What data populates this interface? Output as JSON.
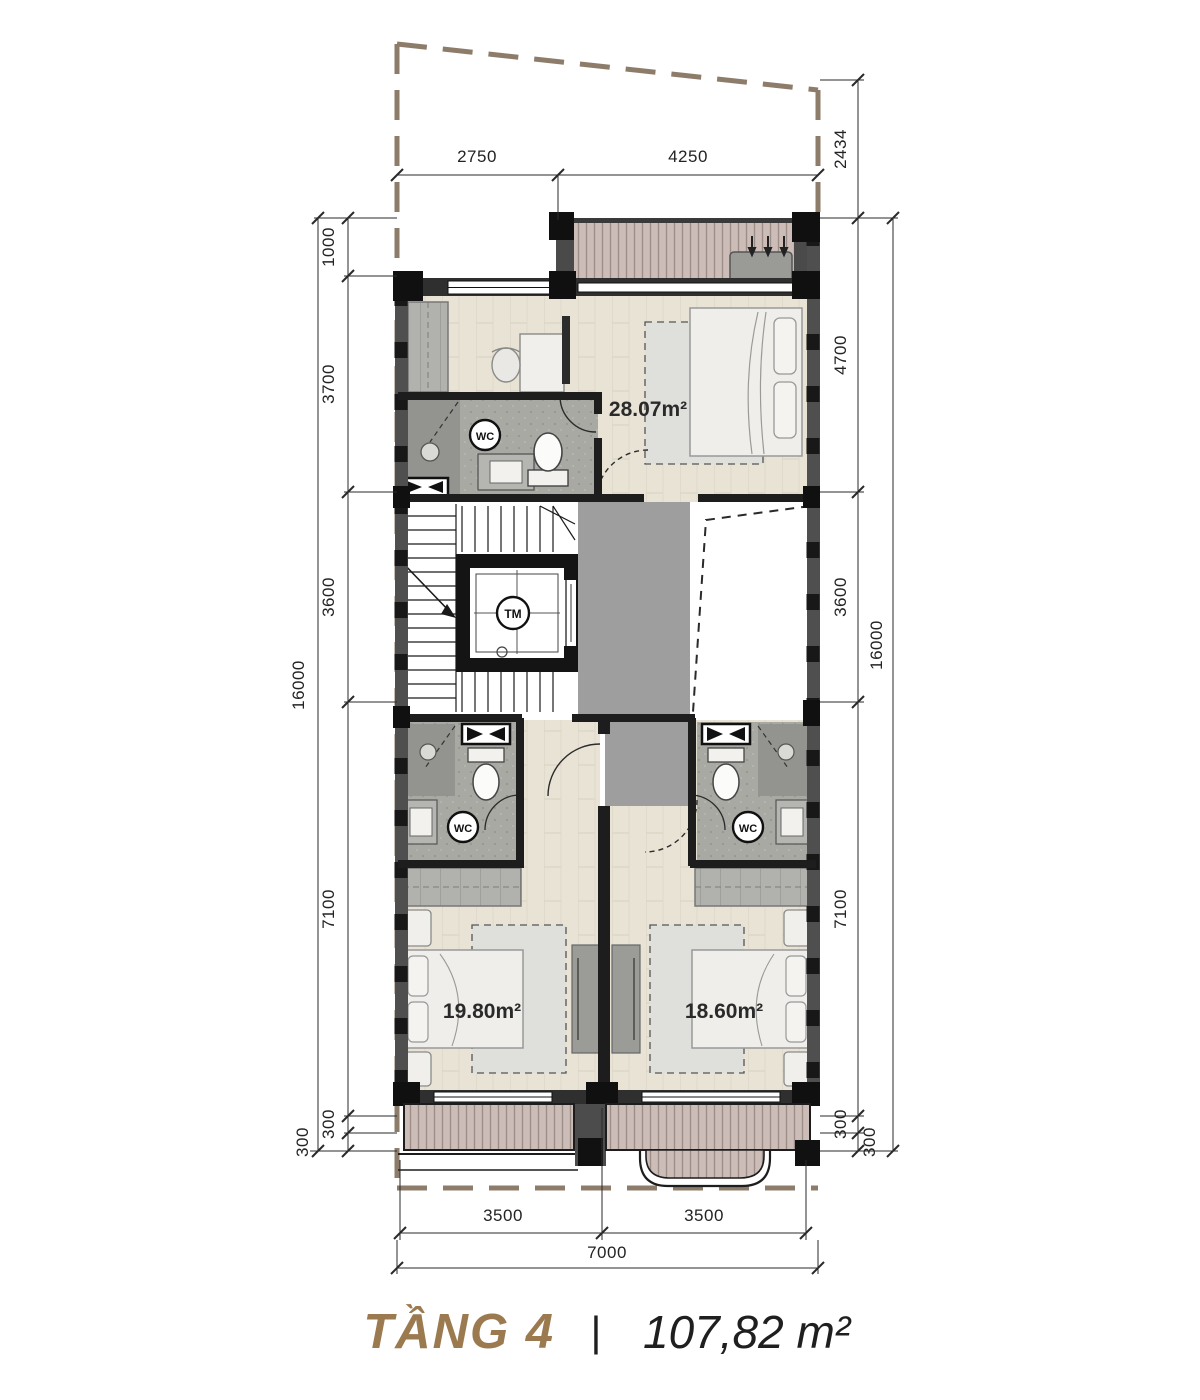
{
  "title": {
    "floor": "TẦNG 4",
    "separator": "|",
    "area": "107,82 m²"
  },
  "rooms": {
    "master": {
      "area_label": "28.07m²"
    },
    "bedroom_left": {
      "area_label": "19.80m²"
    },
    "bedroom_right": {
      "area_label": "18.60m²"
    }
  },
  "labels": {
    "wc": "WC",
    "elevator": "TM"
  },
  "dimensions": {
    "top": [
      "2750",
      "4250"
    ],
    "left": [
      "1000",
      "3700",
      "3600",
      "7100",
      "300",
      "300",
      "16000"
    ],
    "right": [
      "2434",
      "4700",
      "3600",
      "7100",
      "300",
      "300",
      "16000"
    ],
    "bottom": [
      "3500",
      "3500",
      "7000"
    ]
  },
  "colors": {
    "accent_bronze": "#9c7a50",
    "lot_line": "#8d7c6a",
    "wall_dark": "#1d1d1d",
    "wall_grey": "#4f4f4f",
    "wood_floor": "#e8e3d5",
    "deck": "#ccbdb9",
    "bath_floor": "#a9a9a4",
    "corridor": "#9e9e9e",
    "furniture": "#f0efec"
  }
}
